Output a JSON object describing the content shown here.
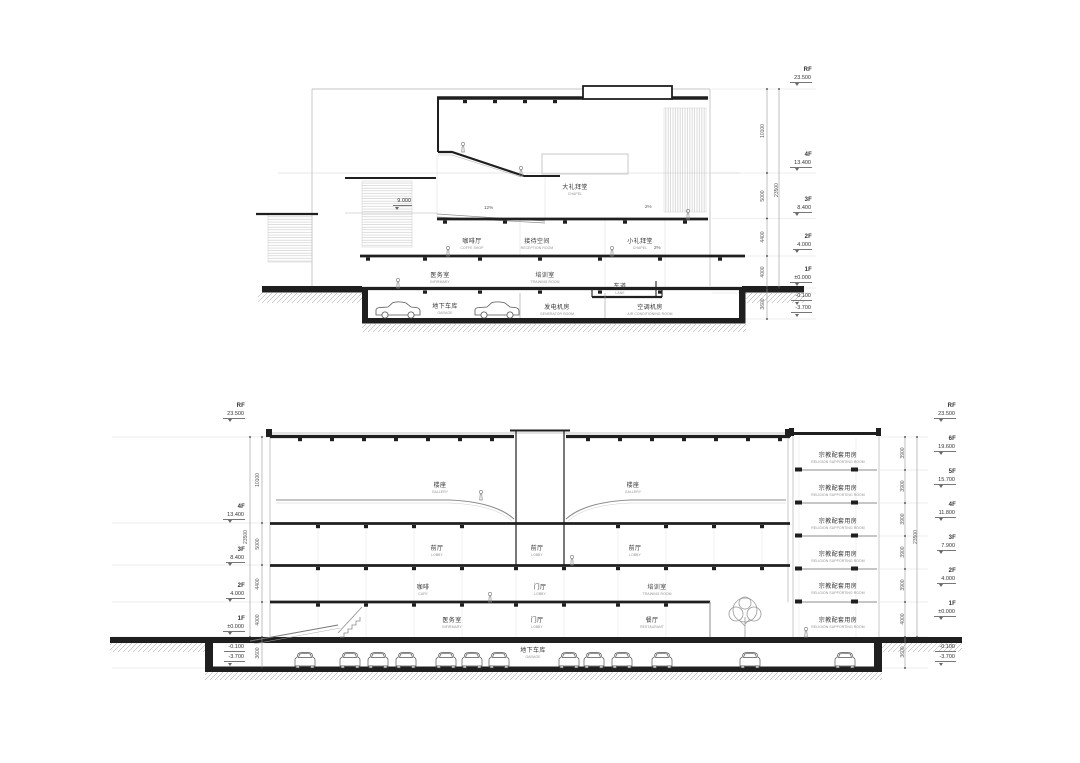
{
  "drawing": {
    "top_section": {
      "levels": [
        {
          "floor": "RF",
          "elev": "23.500"
        },
        {
          "floor": "4F",
          "elev": "13.400"
        },
        {
          "floor": "3F",
          "elev": "8.400"
        },
        {
          "floor": "2F",
          "elev": "4.000"
        },
        {
          "floor": "1F",
          "elev": "±0.000"
        },
        {
          "floor": "",
          "elev": "-0.100"
        },
        {
          "floor": "",
          "elev": "-3.700"
        }
      ],
      "dims": [
        "10100",
        "5000",
        "4400",
        "4000",
        "3600"
      ],
      "overall_dim": "23500",
      "rooms": [
        {
          "zh": "大礼拜堂",
          "en": "CHAPEL"
        },
        {
          "zh": "咖啡厅",
          "en": "COFFE SHOP"
        },
        {
          "zh": "接待空间",
          "en": "RECEPTION ROOM"
        },
        {
          "zh": "小礼拜堂",
          "en": "CHAPEL"
        },
        {
          "zh": "医务室",
          "en": "INFIRMARY"
        },
        {
          "zh": "培训室",
          "en": "TRAINING ROOM"
        },
        {
          "zh": "车道",
          "en": "LANE"
        },
        {
          "zh": "地下车库",
          "en": "GARAGE"
        },
        {
          "zh": "发电机房",
          "en": "GENERATOR ROOM"
        },
        {
          "zh": "空调机房",
          "en": "AIR CONDITIONING ROOM"
        }
      ],
      "annotations": {
        "mezzanine_level": "9.000",
        "ramp_slope": "12%",
        "roof_slope_left": "2%",
        "roof_slope_right": "2%"
      }
    },
    "bottom_section": {
      "levels_left": [
        {
          "floor": "RF",
          "elev": "23.500"
        },
        {
          "floor": "4F",
          "elev": "13.400"
        },
        {
          "floor": "3F",
          "elev": "8.400"
        },
        {
          "floor": "2F",
          "elev": "4.000"
        },
        {
          "floor": "1F",
          "elev": "±0.000"
        },
        {
          "floor": "",
          "elev": "-0.100"
        },
        {
          "floor": "",
          "elev": "-3.700"
        }
      ],
      "dims_left": [
        "10100",
        "5000",
        "4400",
        "4000",
        "3600"
      ],
      "overall_dim_left": "23500",
      "levels_right": [
        {
          "floor": "RF",
          "elev": "23.500"
        },
        {
          "floor": "6F",
          "elev": "19.600"
        },
        {
          "floor": "5F",
          "elev": "15.700"
        },
        {
          "floor": "4F",
          "elev": "11.800"
        },
        {
          "floor": "3F",
          "elev": "7.900"
        },
        {
          "floor": "2F",
          "elev": "4.000"
        },
        {
          "floor": "1F",
          "elev": "±0.000"
        },
        {
          "floor": "",
          "elev": "-0.100"
        },
        {
          "floor": "",
          "elev": "-3.700"
        }
      ],
      "dims_right": [
        "3900",
        "3900",
        "3900",
        "3900",
        "3900",
        "4000",
        "3600"
      ],
      "overall_dim_right": "23500",
      "rooms": [
        {
          "zh": "楼座",
          "en": "GALLERY"
        },
        {
          "zh": "楼座",
          "en": "GALLERY"
        },
        {
          "zh": "前厅",
          "en": "LOBBY"
        },
        {
          "zh": "前厅",
          "en": "LOBBY"
        },
        {
          "zh": "前厅",
          "en": "LOBBY"
        },
        {
          "zh": "咖啡",
          "en": "CAFE"
        },
        {
          "zh": "门厅",
          "en": "LOBBY"
        },
        {
          "zh": "培训室",
          "en": "TRAINING ROOM"
        },
        {
          "zh": "医务室",
          "en": "INFIRMARY"
        },
        {
          "zh": "门厅",
          "en": "LOBBY"
        },
        {
          "zh": "餐厅",
          "en": "RESTAURANT"
        },
        {
          "zh": "地下车库",
          "en": "GARAGE"
        },
        {
          "zh": "宗教配套用房",
          "en": "RELIGION SUPPORTING ROOM"
        },
        {
          "zh": "宗教配套用房",
          "en": "RELIGION SUPPORTING ROOM"
        },
        {
          "zh": "宗教配套用房",
          "en": "RELIGION SUPPORTING ROOM"
        },
        {
          "zh": "宗教配套用房",
          "en": "RELIGION SUPPORTING ROOM"
        },
        {
          "zh": "宗教配套用房",
          "en": "RELIGION SUPPORTING ROOM"
        },
        {
          "zh": "宗教配套用房",
          "en": "RELIGION SUPPORTING ROOM"
        }
      ]
    }
  }
}
